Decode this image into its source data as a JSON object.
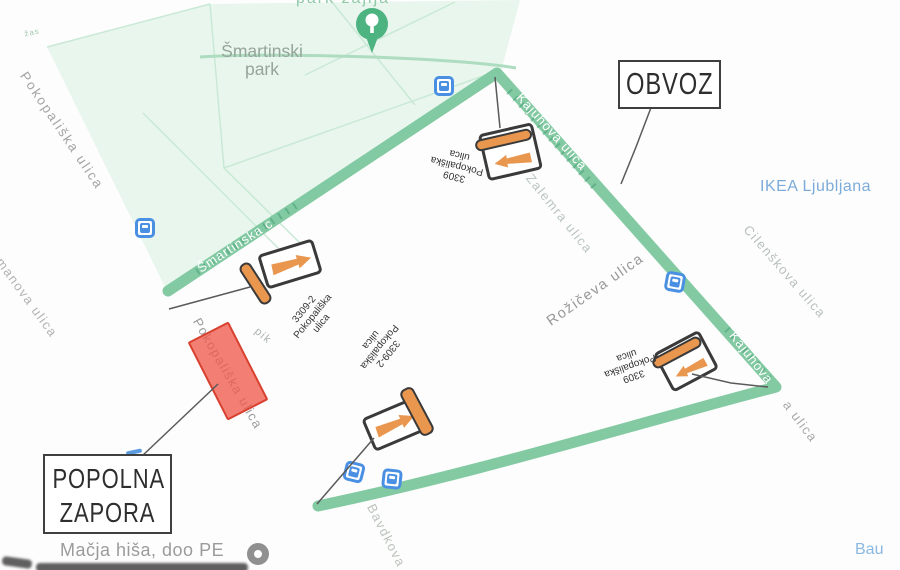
{
  "colors": {
    "route_green": "#7cc79e",
    "route_tick_green": "#2f8f63",
    "closure_red": "#f05a48",
    "closure_border": "#d8402f",
    "sign_orange": "#e9964e",
    "bus_blue": "#4a90e2",
    "park_fill": "#e9f6ee",
    "poi_blue": "#7cabd9"
  },
  "park": {
    "line1": "Šmartinski",
    "line2": "park"
  },
  "streets": {
    "pokopaliska_nw": "Pokopališka ulica",
    "manova": "manova ulica",
    "smartinska": "Šmartinska c",
    "kajuhova_top": "Kajuhova ulica",
    "zalemra": "Zalemra ulica",
    "roziceva": "Rožičeva ulica",
    "cilenskova": "Cilenškova ulica",
    "kajuhova_corner": "Kajuhova",
    "kajuhova_tail": "a ulica",
    "pokopaliska_closure": "Pokopališka ulica",
    "bavdkova": "Bavdkova",
    "pik_fragment": "pik",
    "zas_fragment": "žas",
    "top_cut": "park žajlja"
  },
  "pois": {
    "ikea": "IKEA Ljubljana",
    "macja": "Mačja hiša, doo PE",
    "bau": "Bau"
  },
  "annotations": {
    "obvoz": "OBVOZ",
    "zapora_line1": "POPOLNA",
    "zapora_line2": "ZAPORA",
    "signs": [
      {
        "position": "top",
        "code": "3309",
        "street": "Pokopališka",
        "suffix": "ulica"
      },
      {
        "position": "left",
        "code": "3309-2",
        "street": "Pokopališka",
        "suffix": "ulica"
      },
      {
        "position": "bottom",
        "code": "3309-2",
        "street": "Pokopališka",
        "suffix": "ulica"
      },
      {
        "position": "right",
        "code": "3309",
        "street": "Pokopališka",
        "suffix": "ulica"
      }
    ]
  }
}
